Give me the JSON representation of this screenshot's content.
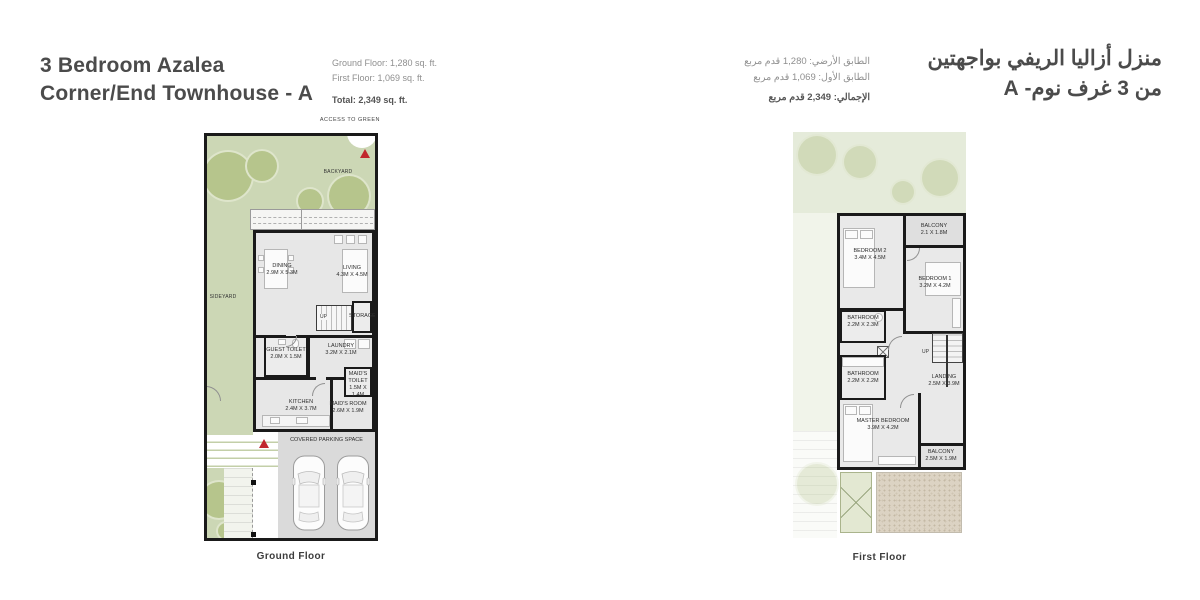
{
  "header_left": {
    "title_line1": "3 Bedroom Azalea",
    "title_line2": "Corner/End Townhouse - A",
    "area_ground": "Ground Floor: 1,280 sq. ft.",
    "area_first": "First Floor: 1,069 sq. ft.",
    "area_total": "Total: 2,349 sq. ft."
  },
  "header_right": {
    "title_line1": "منزل أزاليا الريفي بواجهتين",
    "title_line2": "من 3 غرف نوم- A",
    "area_ground": "الطابق الأرضي: 1,280 قدم مربع",
    "area_first": "الطابق الأول: 1,069 قدم مربع",
    "area_total": "الإجمالي: 2,349 قدم مربع"
  },
  "ground_floor": {
    "caption": "Ground Floor",
    "access_label": "ACCESS TO GREEN",
    "backyard_label": "BACKYARD",
    "sideyard_label": "SIDEYARD",
    "parking_label": "COVERED PARKING SPACE",
    "up_label": "UP",
    "rooms": {
      "dining": {
        "name": "DINING",
        "dims": "2.9M X 5.3M"
      },
      "living": {
        "name": "LIVING",
        "dims": "4.3M X 4.5M"
      },
      "storage": {
        "name": "STORAGE",
        "dims": ""
      },
      "guest_toilet": {
        "name": "GUEST TOILET",
        "dims": "2.0M X 1.5M"
      },
      "laundry": {
        "name": "LAUNDRY",
        "dims": "3.2M X 2.1M"
      },
      "maids_toilet": {
        "name": "MAID'S TOILET",
        "dims": "1.5M X 1.4M"
      },
      "kitchen": {
        "name": "KITCHEN",
        "dims": "2.4M X 3.7M"
      },
      "maids_room": {
        "name": "MAID'S ROOM",
        "dims": "2.6M X 1.9M"
      }
    }
  },
  "first_floor": {
    "caption": "First Floor",
    "up_label": "UP",
    "rooms": {
      "bedroom2": {
        "name": "BEDROOM 2",
        "dims": "3.4M X 4.5M"
      },
      "balcony_top": {
        "name": "BALCONY",
        "dims": "2.1 X 1.8M"
      },
      "bedroom1": {
        "name": "BEDROOM 1",
        "dims": "3.2M X 4.2M"
      },
      "bathroom1": {
        "name": "BATHROOM",
        "dims": "2.2M X 2.3M"
      },
      "bathroom2": {
        "name": "BATHROOM",
        "dims": "2.2M X 2.2M"
      },
      "landing": {
        "name": "LANDING",
        "dims": "2.5M X 3.9M"
      },
      "master_bedroom": {
        "name": "MASTER BEDROOM",
        "dims": "3.9M X 4.2M"
      },
      "balcony_bottom": {
        "name": "BALCONY",
        "dims": "2.5M X 1.9M"
      }
    }
  },
  "colors": {
    "accent_red": "#c1272d",
    "yard_green": "#ccd7b5",
    "tree_green": "#b6c58c",
    "wall_black": "#1a1a1a",
    "floor_gray": "#e7e7e7",
    "parking_gray": "#dadada",
    "speckle_beige": "#dcd3c3",
    "title_gray": "#4b4b4b"
  }
}
